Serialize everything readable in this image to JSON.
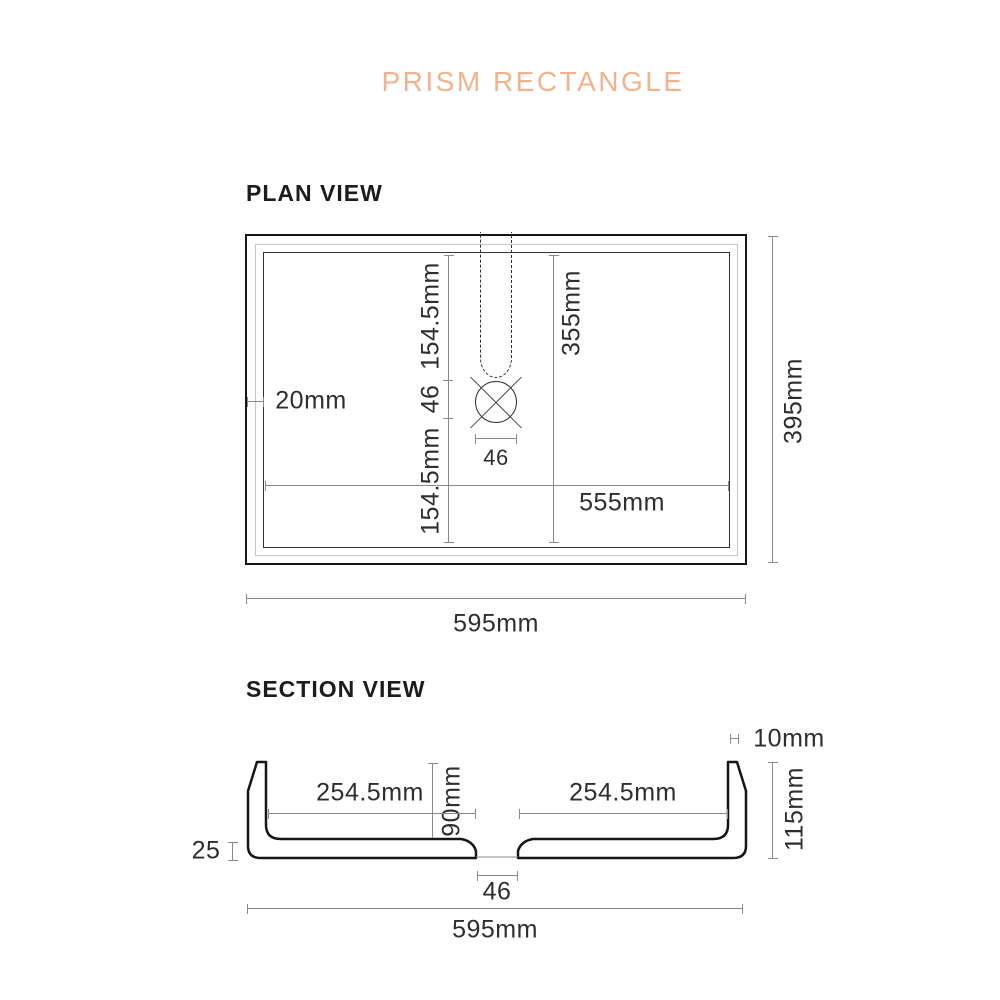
{
  "title": "PRISM RECTANGLE",
  "colors": {
    "accent": "#F2B28C",
    "drawing_ink": "#161616",
    "dim_line": "#8a8a8a",
    "dim_text": "#2e2e2e"
  },
  "plan": {
    "heading": "PLAN VIEW",
    "dims": {
      "wall_thickness": "20mm",
      "center_top": "154.5mm",
      "center_mid": "46",
      "center_bottom": "154.5mm",
      "inner_height": "355mm",
      "inner_width": "555mm",
      "hole_diameter": "46",
      "overall_width": "595mm",
      "overall_height": "395mm"
    }
  },
  "section": {
    "heading": "SECTION VIEW",
    "dims": {
      "rim_thickness": "10mm",
      "left_half": "254.5mm",
      "right_half": "254.5mm",
      "bowl_depth": "90mm",
      "overall_height": "115mm",
      "base_thickness": "25",
      "drain_width": "46",
      "overall_width": "595mm"
    }
  }
}
